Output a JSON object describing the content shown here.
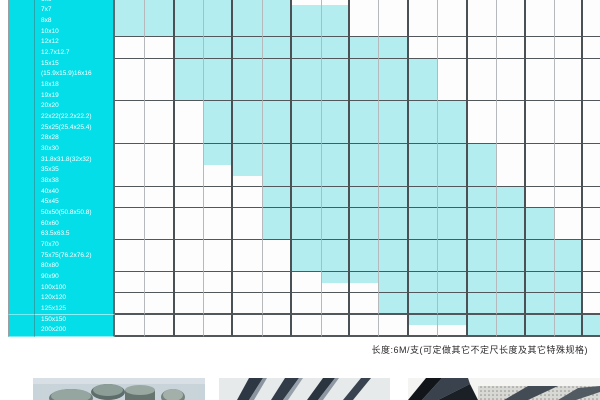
{
  "page": {
    "footnote": "长度:6M/支(可定做其它不定尺长度及其它特殊规格)"
  },
  "colors": {
    "label_cyan": "#03dee9",
    "available_cyan": "#b3edef",
    "empty_cell": "#fdfdfd",
    "grid_light": "#b5b9bb",
    "grid_dark": "#4a5054"
  },
  "table": {
    "description": "size vs wall-thickness availability matrix; cyan cell = available",
    "num_thickness_columns": 17,
    "rows": [
      {
        "label": "6x6",
        "from": 1,
        "to": 6
      },
      {
        "label": "7x7",
        "from": 1,
        "to": 8
      },
      {
        "label": "8x8",
        "from": 1,
        "to": 8
      },
      {
        "label": "10x10",
        "from": 1,
        "to": 8
      },
      {
        "label": "12x12",
        "from": 3,
        "to": 10
      },
      {
        "label": "12.7x12.7",
        "from": 3,
        "to": 10
      },
      {
        "label": "15x15",
        "from": 3,
        "to": 11
      },
      {
        "label": "(15.9x15.9)16x16",
        "from": 3,
        "to": 11
      },
      {
        "label": "18x18",
        "from": 3,
        "to": 11
      },
      {
        "label": "19x19",
        "from": 3,
        "to": 11
      },
      {
        "label": "20x20",
        "from": 4,
        "to": 12
      },
      {
        "label": "22x22(22.2x22.2)",
        "from": 4,
        "to": 12
      },
      {
        "label": "25x25(25.4x25.4)",
        "from": 4,
        "to": 12
      },
      {
        "label": "28x28",
        "from": 4,
        "to": 12
      },
      {
        "label": "30x30",
        "from": 4,
        "to": 13
      },
      {
        "label": "31.8x31.8(32x32)",
        "from": 4,
        "to": 13
      },
      {
        "label": "35x35",
        "from": 5,
        "to": 13
      },
      {
        "label": "38x38",
        "from": 6,
        "to": 13
      },
      {
        "label": "40x40",
        "from": 6,
        "to": 14
      },
      {
        "label": "45x45",
        "from": 6,
        "to": 14
      },
      {
        "label": "50x50(50.8x50.8)",
        "from": 6,
        "to": 15
      },
      {
        "label": "60x60",
        "from": 6,
        "to": 15
      },
      {
        "label": "63.5x63.5",
        "from": 6,
        "to": 15
      },
      {
        "label": "70x70",
        "from": 7,
        "to": 16
      },
      {
        "label": "75x75(76.2x76.2)",
        "from": 7,
        "to": 16
      },
      {
        "label": "80x80",
        "from": 7,
        "to": 16
      },
      {
        "label": "90x90",
        "from": 8,
        "to": 16
      },
      {
        "label": "100x100",
        "from": 10,
        "to": 16
      },
      {
        "label": "120x120",
        "from": 10,
        "to": 16
      },
      {
        "label": "125x125",
        "from": 10,
        "to": 16
      },
      {
        "label": "150x150",
        "from": 11,
        "to": 17
      },
      {
        "label": "200x200",
        "from": 13,
        "to": 17
      }
    ]
  },
  "photos": [
    {
      "name": "round-bar-stock",
      "alt": "stainless round bars / cylinders"
    },
    {
      "name": "flat-bar-stock",
      "alt": "stainless flat bars leaning"
    },
    {
      "name": "angle-channel-stock",
      "alt": "angle and channel steel profiles"
    }
  ]
}
